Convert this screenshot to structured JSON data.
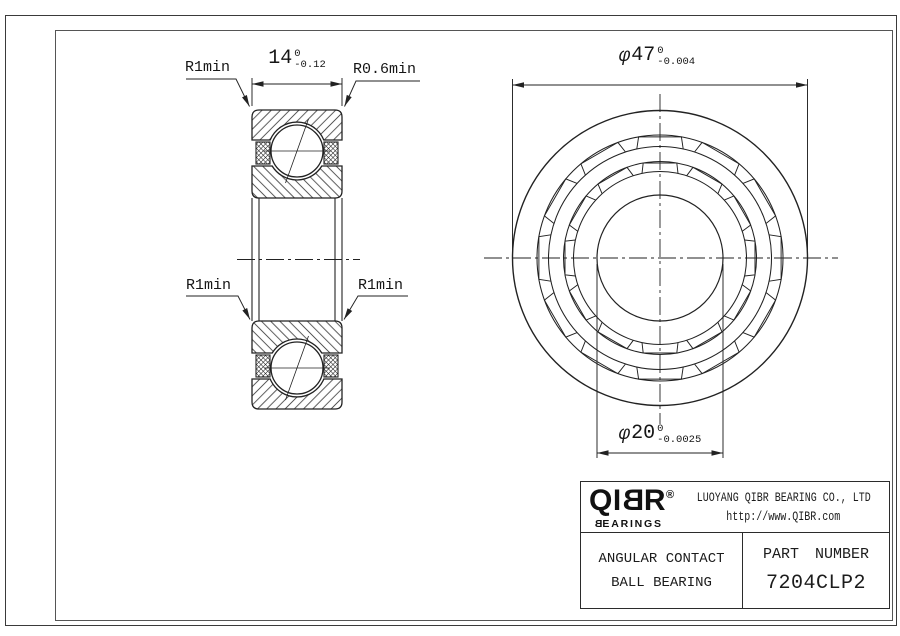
{
  "drawing": {
    "section_view": {
      "corner_labels": {
        "top_left": "R1min",
        "top_right": "R0.6min",
        "bottom_left": "R1min",
        "bottom_right": "R1min"
      },
      "width_dim": {
        "value": "14",
        "tol_upper": "0",
        "tol_lower": "-0.12"
      }
    },
    "front_view": {
      "outer_diameter_dim": {
        "symbol": "φ",
        "value": "47",
        "tol_upper": "0",
        "tol_lower": "-0.004"
      },
      "bore_diameter_dim": {
        "symbol": "φ",
        "value": "20",
        "tol_upper": "0",
        "tol_lower": "-0.0025"
      }
    }
  },
  "title_block": {
    "logo": {
      "text": "QIBR",
      "registered": "®",
      "sub_first": "B",
      "sub_rest": "EARINGS"
    },
    "company": "LUOYANG QIBR BEARING CO., LTD",
    "website": "http://www.QIBR.com",
    "product_line1": "ANGULAR CONTACT",
    "product_line2": "BALL BEARING",
    "part_label": "PART NUMBER",
    "part_number": "7204CLP2"
  }
}
